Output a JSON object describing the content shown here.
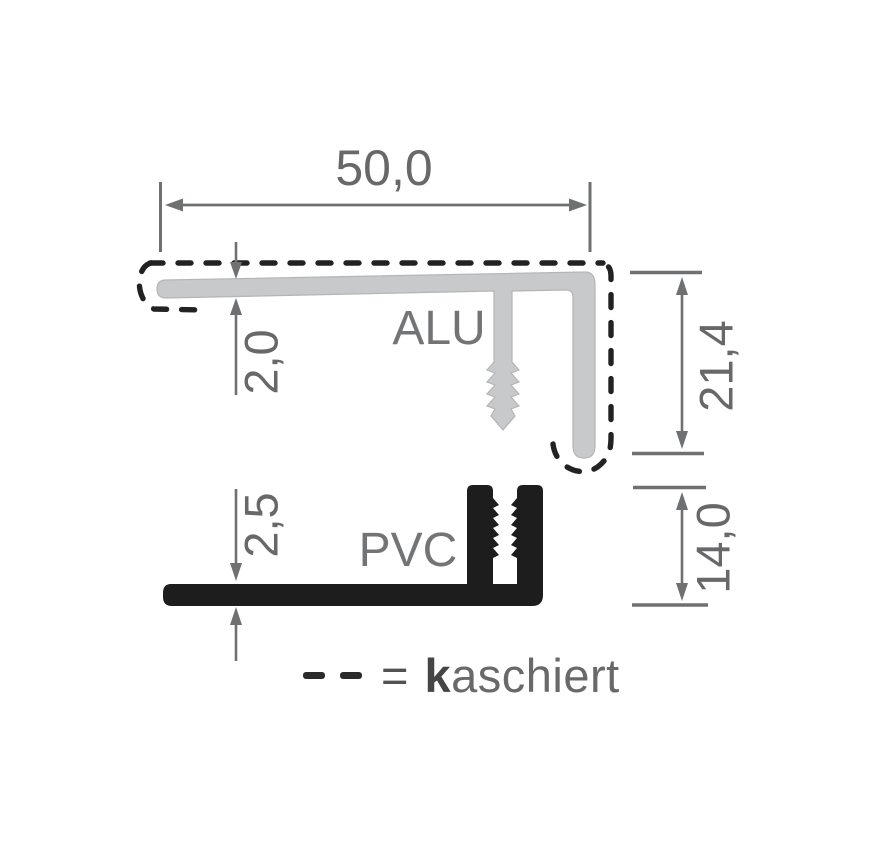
{
  "drawing": {
    "profiles": [
      {
        "name": "alu",
        "label": "ALU",
        "fill": "#c8c9cb"
      },
      {
        "name": "pvc",
        "label": "PVC",
        "fill": "#1d1d1d"
      }
    ],
    "dimensions": {
      "top_width": "50,0",
      "alu_thickness": "2,0",
      "alu_leg_height": "21,4",
      "pvc_thickness": "2,5",
      "pvc_leg_height": "14,0"
    },
    "legend": {
      "dash_icon": "dashed-line-sample",
      "equals": "=",
      "term_initial": "k",
      "term_rest": "aschiert"
    },
    "colors": {
      "background": "#ffffff",
      "alu_fill": "#c8c9cb",
      "pvc_fill": "#1d1d1d",
      "dimension_gray": "#6f7072",
      "text_gray": "#68686a",
      "dash_black": "#222222"
    }
  }
}
